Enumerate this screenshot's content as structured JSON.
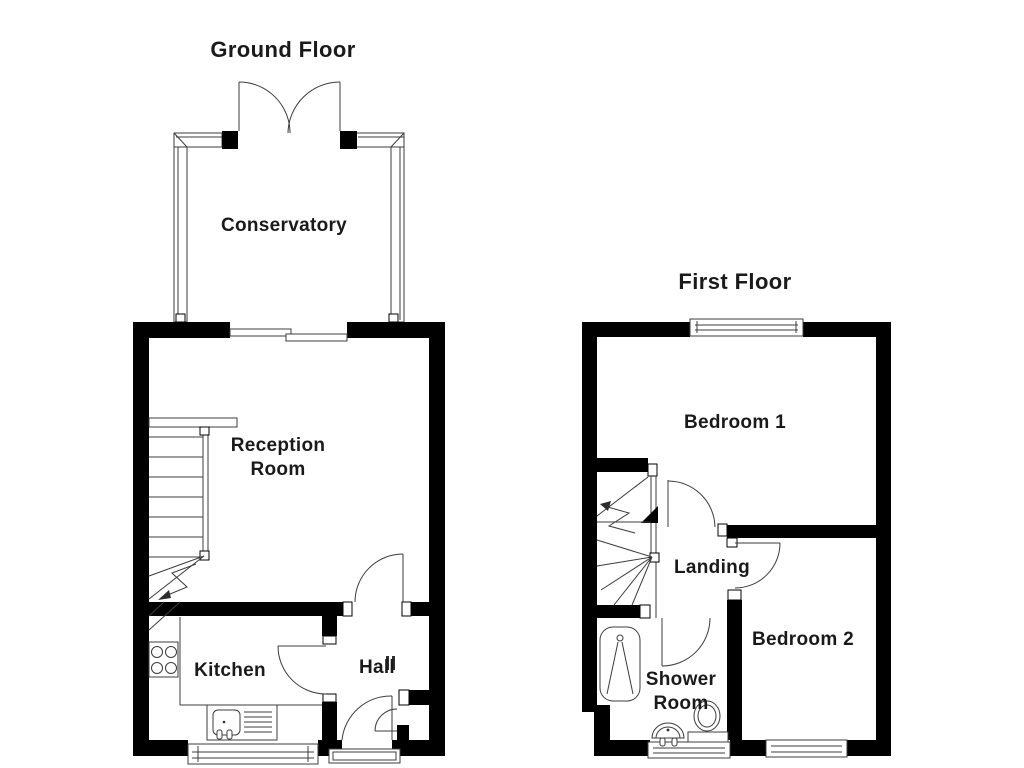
{
  "ground_floor": {
    "title": "Ground Floor",
    "rooms": {
      "conservatory": "Conservatory",
      "reception_line1": "Reception",
      "reception_line2": "Room",
      "kitchen": "Kitchen",
      "hall": "Hall"
    }
  },
  "first_floor": {
    "title": "First Floor",
    "rooms": {
      "bedroom1": "Bedroom 1",
      "landing": "Landing",
      "bedroom2": "Bedroom 2",
      "shower_line1": "Shower",
      "shower_line2": "Room"
    }
  },
  "colors": {
    "wall": "#000000",
    "line": "#3c3c3c",
    "text": "#1a1a1a",
    "background": "#ffffff"
  }
}
